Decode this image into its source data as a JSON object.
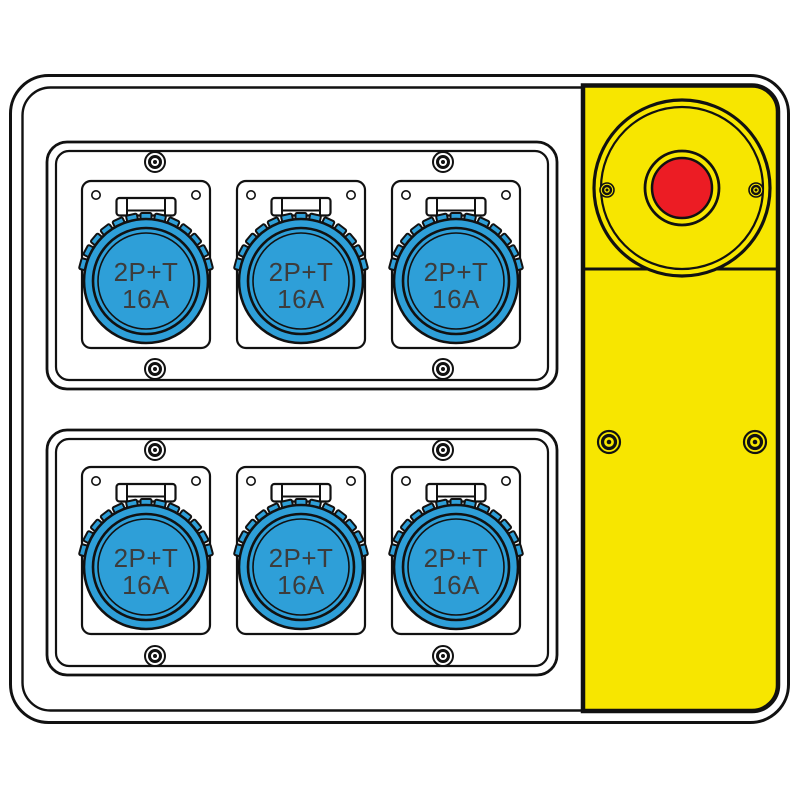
{
  "illustration": {
    "subject": "power-distribution-box",
    "rows": 2,
    "sockets_per_row": 3,
    "socket_count": 6
  },
  "sockets": [
    {
      "line1": "2P+T",
      "line2": "16A"
    },
    {
      "line1": "2P+T",
      "line2": "16A"
    },
    {
      "line1": "2P+T",
      "line2": "16A"
    },
    {
      "line1": "2P+T",
      "line2": "16A"
    },
    {
      "line1": "2P+T",
      "line2": "16A"
    },
    {
      "line1": "2P+T",
      "line2": "16A"
    }
  ],
  "colors": {
    "socket_blue": "#2E9FD8",
    "panel_yellow": "#F7E600",
    "button_red": "#EC1C24",
    "outline": "#111111",
    "label_text": "#3C3C3C",
    "background": "#FFFFFF"
  }
}
